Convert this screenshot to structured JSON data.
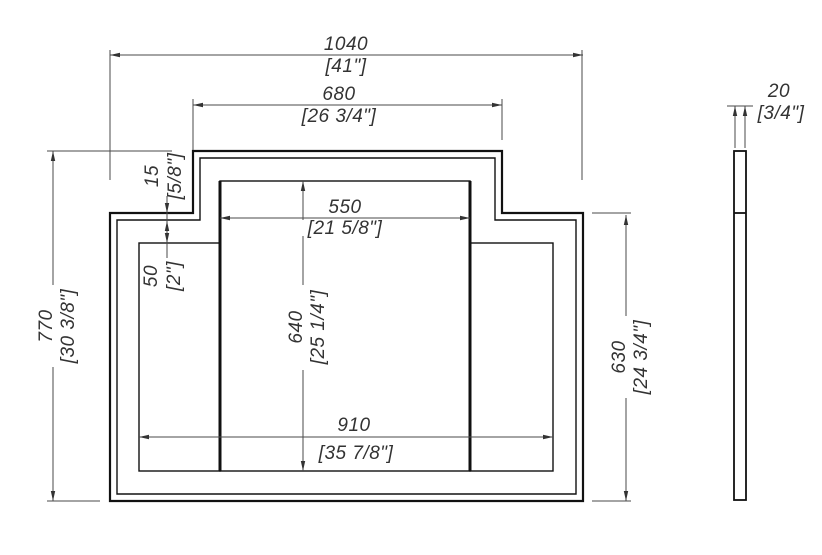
{
  "drawing": {
    "type": "technical-elevation-drawing",
    "views": {
      "front_view": "stepped panel front elevation",
      "side_view": "thin profile section"
    },
    "dimensions": {
      "overall_width": {
        "mm": "1040",
        "inches": "[41\"]"
      },
      "upper_section_width": {
        "mm": "680",
        "inches": "[26 3/4\"]"
      },
      "center_panel_width": {
        "mm": "550",
        "inches": "[21 5/8\"]"
      },
      "frame_thickness": {
        "mm": "15",
        "inches": "[5/8\"]"
      },
      "panel_top_inset": {
        "mm": "50",
        "inches": "[2\"]"
      },
      "center_panel_height": {
        "mm": "640",
        "inches": "[25 1/4\"]"
      },
      "overall_height": {
        "mm": "770",
        "inches": "[30 3/8\"]"
      },
      "inner_panels_width": {
        "mm": "910",
        "inches": "[35 7/8\"]"
      },
      "side_section_height": {
        "mm": "630",
        "inches": "[24 3/4\"]"
      },
      "material_thickness": {
        "mm": "20",
        "inches": "[3/4\"]"
      }
    },
    "colors": {
      "object_line": "#111111",
      "dimension_line": "#4a4a4a",
      "text": "#333333",
      "background": "#ffffff"
    }
  }
}
